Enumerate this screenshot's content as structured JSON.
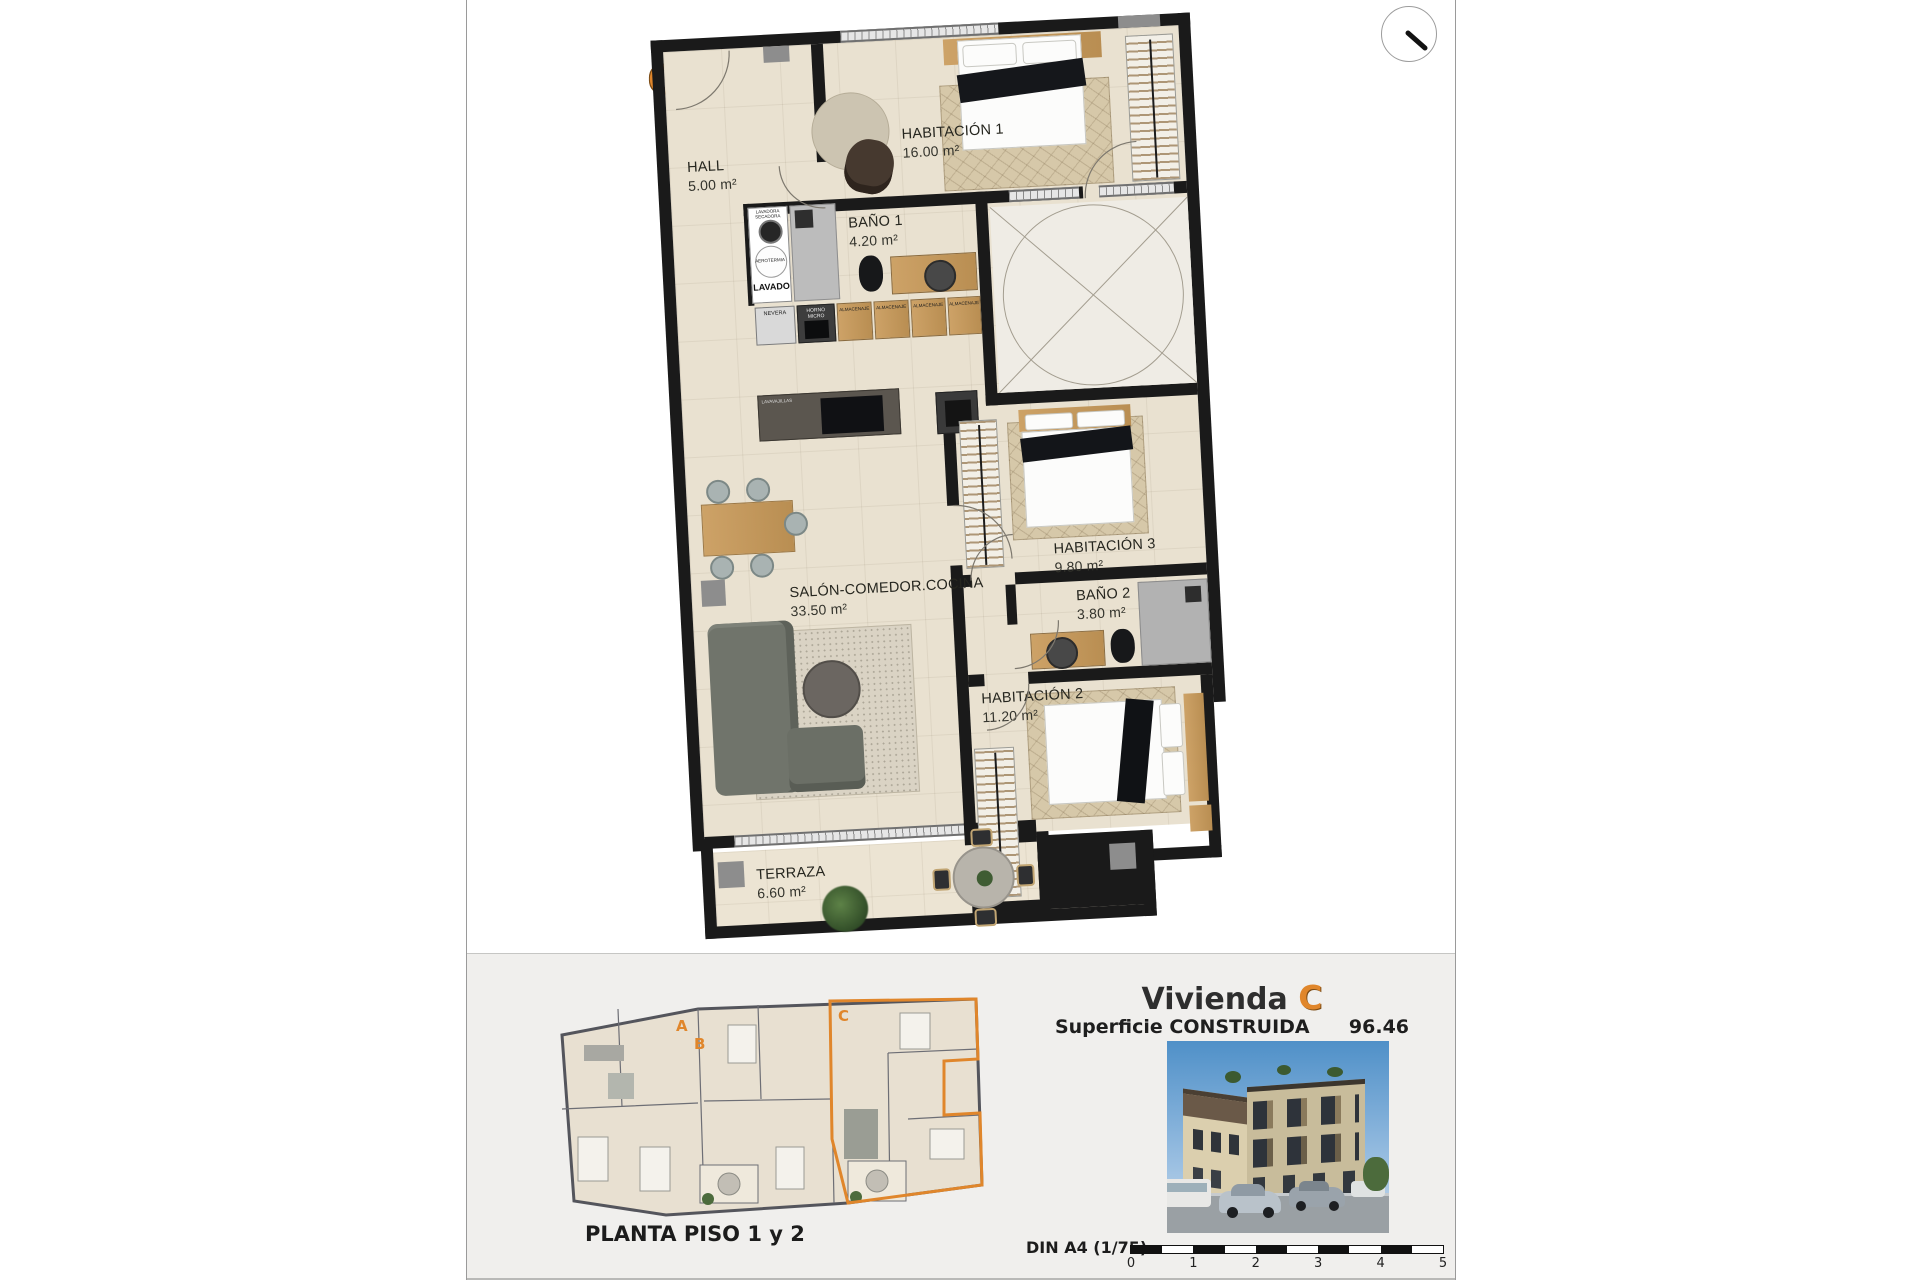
{
  "plan": {
    "unit_letter": "C",
    "rooms": {
      "hall": {
        "name": "HALL",
        "area": "5.00 m²"
      },
      "habitacion1": {
        "name": "HABITACIÓN 1",
        "area": "16.00 m²"
      },
      "bano1": {
        "name": "BAÑO 1",
        "area": "4.20 m²"
      },
      "salon": {
        "name": "SALÓN-COMEDOR.COCINA",
        "area": "33.50 m²"
      },
      "habitacion3": {
        "name": "HABITACIÓN 3",
        "area": "9.80 m²"
      },
      "bano2": {
        "name": "BAÑO 2",
        "area": "3.80 m²"
      },
      "habitacion2": {
        "name": "HABITACIÓN 2",
        "area": "11.20 m²"
      },
      "terraza": {
        "name": "TERRAZA",
        "area": "6.60 m²"
      }
    },
    "appliances": {
      "laundry_top": "LAVADORA SECADORA",
      "laundry_mid": "AEROTERMIA",
      "laundry_label": "LAVADO",
      "island_label": "LAVAVAJILLAS",
      "kitchen_units": [
        "NEVERA",
        "HORNO MICRO",
        "ALMACENAJE",
        "ALMACENAJE",
        "ALMACENAJE",
        "ALMACENAJE"
      ]
    }
  },
  "footer": {
    "caption": "PLANTA PISO 1 y 2",
    "mini_units": [
      "A",
      "B",
      "C"
    ],
    "title_text": "Vivienda",
    "title_letter": "C",
    "surface_label": "Superficie CONSTRUIDA",
    "surface_value": "96.46 m²",
    "scale_label": "DIN A4 (1/75)",
    "scale_ticks": [
      "0",
      "1",
      "2",
      "3",
      "4",
      "5"
    ]
  },
  "colors": {
    "accent_orange": "#e0862b",
    "wall_black": "#1a1a1a",
    "floor_beige": "#e9e1d0"
  }
}
